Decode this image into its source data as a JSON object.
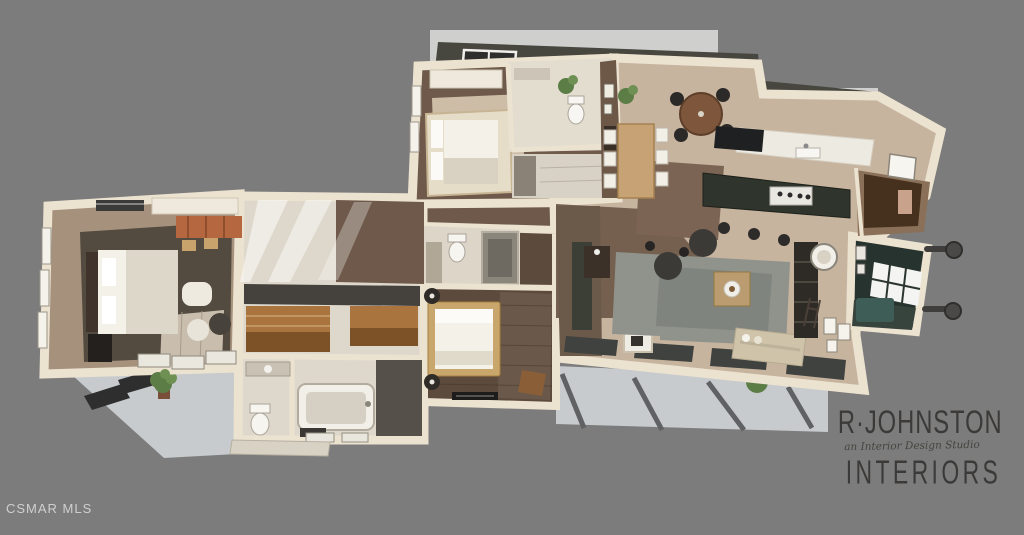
{
  "watermark": "CSMAR MLS",
  "logo": {
    "name": "R·JOHNSTON",
    "tagline": "an Interior Design Studio",
    "subtitle": "INTERIORS"
  },
  "colors": {
    "background": "#7c7c7c",
    "light_patch": "#cfd0ce",
    "patio": "#c7cbcd",
    "wall_cream": "#ece2d0",
    "roof_dark": "#47463f",
    "skylight_frame": "#f0efec",
    "skylight_glass": "#2e2e2c",
    "floor_wood_dark": "#6e594a",
    "floor_wood_light": "#c7b49f",
    "floor_tan": "#a6927c",
    "hall_white": "#ded8cc",
    "rug_tan": "#cdbda6",
    "carpet_master": "#534a40",
    "carpet_bedroom3": "#5c4a3c",
    "rug_living": "#90938c",
    "island_granite": "#2f342c",
    "counter_white": "#edeae2",
    "den_teal": "#27332e",
    "den_sofa_teal": "#3f5d57",
    "fireplace_panel": "#5d7480",
    "plant_green": "#5d7d47",
    "plant_green_light": "#6f9053",
    "sofa_beige": "#cfc3aa",
    "bed_white": "#f4f1e9",
    "wood_warm": "#a9743e",
    "cabinet_dark": "#46311f",
    "post_dark": "#5f6163",
    "rust_rug": "#b5673f",
    "logo_text": "#3b3a38",
    "watermark_text": "#d9d9d9"
  },
  "scene": {
    "type": "3d-rendered-floor-plan",
    "rooms": [
      "master-bedroom",
      "walk-in-closet",
      "master-bathroom",
      "bedroom-2",
      "bathroom-2",
      "entry-hall",
      "dining-area",
      "kitchen",
      "pantry",
      "hallway",
      "bedroom-3",
      "bathroom-3",
      "living-room",
      "den",
      "patio-left",
      "patio-right"
    ]
  }
}
